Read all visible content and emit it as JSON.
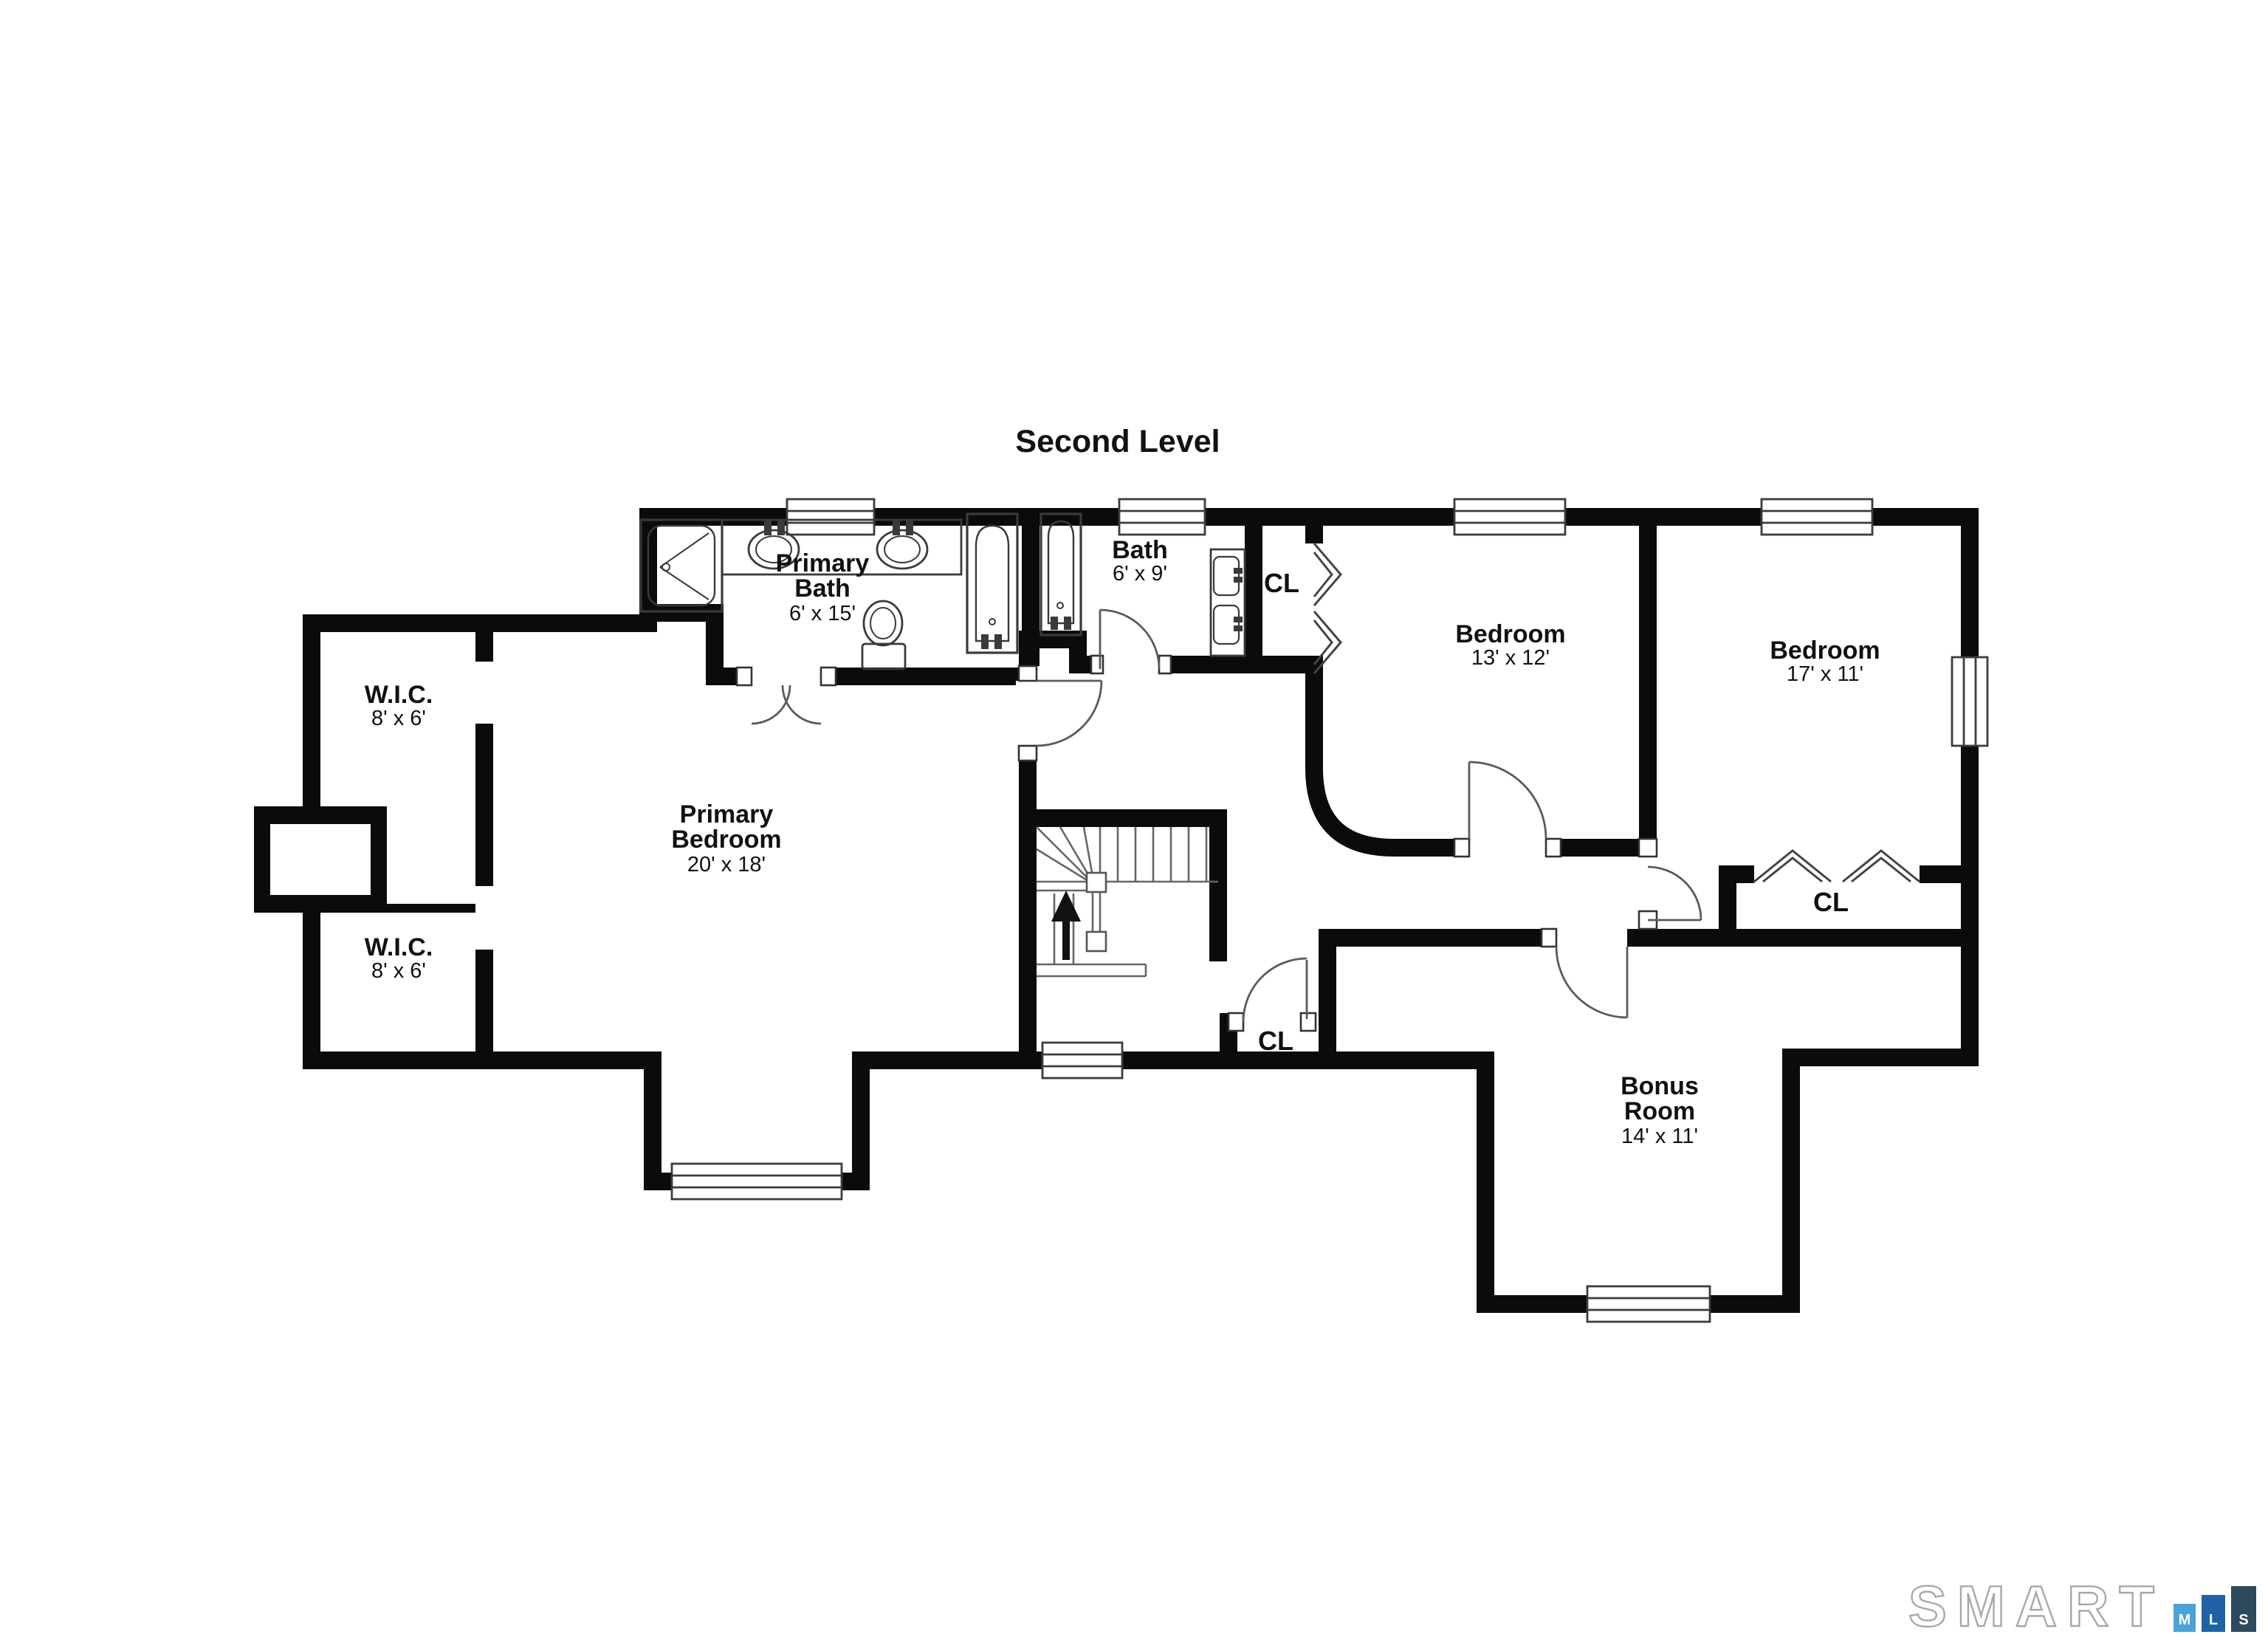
{
  "title": "Second Level",
  "rooms": {
    "primary_bath": {
      "name": "Primary Bath",
      "dims": "6' x 15'"
    },
    "bath": {
      "name": "Bath",
      "dims": "6' x 9'"
    },
    "primary_bedroom": {
      "name": "Primary Bedroom",
      "dims": "20' x 18'"
    },
    "bedroom_13": {
      "name": "Bedroom",
      "dims": "13' x 12'"
    },
    "bedroom_17": {
      "name": "Bedroom",
      "dims": "17' x 11'"
    },
    "bonus_room": {
      "name": "Bonus Room",
      "dims": "14' x 11'"
    },
    "wic_upper": {
      "name": "W.I.C.",
      "dims": "8' x 6'"
    },
    "wic_lower": {
      "name": "W.I.C.",
      "dims": "8' x 6'"
    }
  },
  "closets": {
    "bath_closet": "CL",
    "hall_closet": "CL",
    "bedroom_closet": "CL"
  },
  "logo": {
    "brand": "SMART",
    "blocks": [
      {
        "letter": "M",
        "color": "#4aa2d9"
      },
      {
        "letter": "L",
        "color": "#2062a8"
      },
      {
        "letter": "S",
        "color": "#2b4a5b"
      }
    ]
  },
  "colors": {
    "walls": "#0b0b0b",
    "fixtures": "#3a3a3a",
    "background": "#ffffff"
  }
}
